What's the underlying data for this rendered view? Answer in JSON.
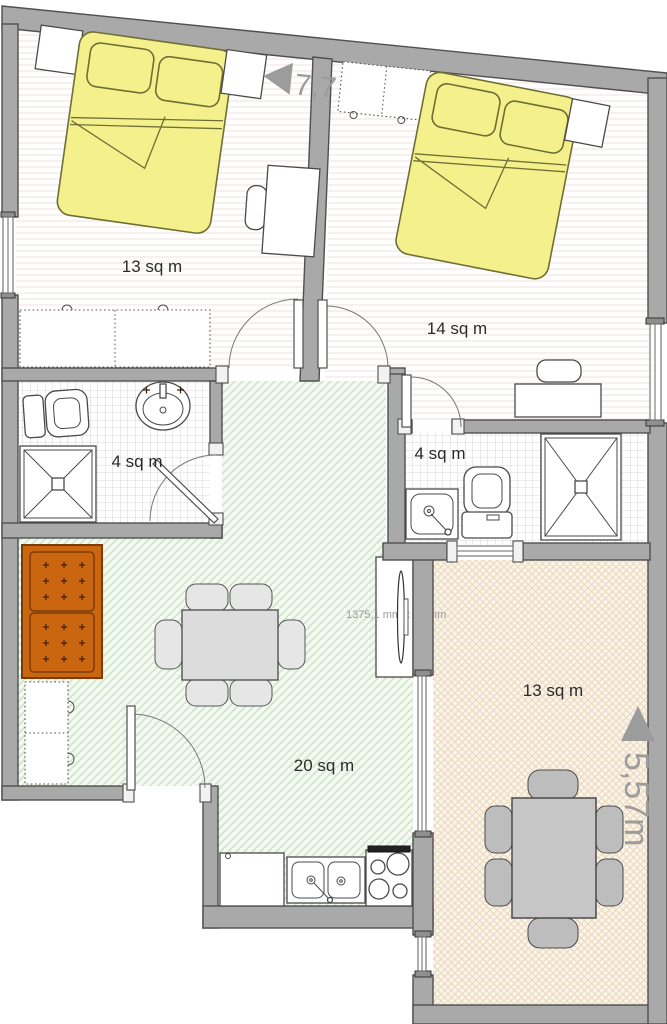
{
  "floorplan": {
    "rooms": {
      "bedroom_left": {
        "name": "bedroom-left",
        "area_label": "13 sq m"
      },
      "bedroom_right": {
        "name": "bedroom-right",
        "area_label": "14 sq m"
      },
      "bathroom_left": {
        "name": "bathroom-left",
        "area_label": "4 sq m"
      },
      "bathroom_right": {
        "name": "bathroom-right",
        "area_label": "4 sq m"
      },
      "living_room": {
        "name": "living-room",
        "area_label": "20 sq m"
      },
      "terrace": {
        "name": "terrace-dining",
        "area_label": "13 sq m"
      }
    },
    "dimensions": {
      "top_width_label": "7,7",
      "right_height_label": "5,57m",
      "tv_unit_label": "1375,1 mm x 00 mm"
    },
    "colors": {
      "wall": "#a9a9a9",
      "bed": "#f4f08c",
      "sofa": "#c9660f",
      "living_floor_hatch": "#d4e6d0",
      "terrace_floor_hatch": "#ecd9bd",
      "tile_grid": "#cccccc",
      "dimension_text": "#9c9c9c",
      "room_label_text": "#2b2b2b"
    }
  }
}
